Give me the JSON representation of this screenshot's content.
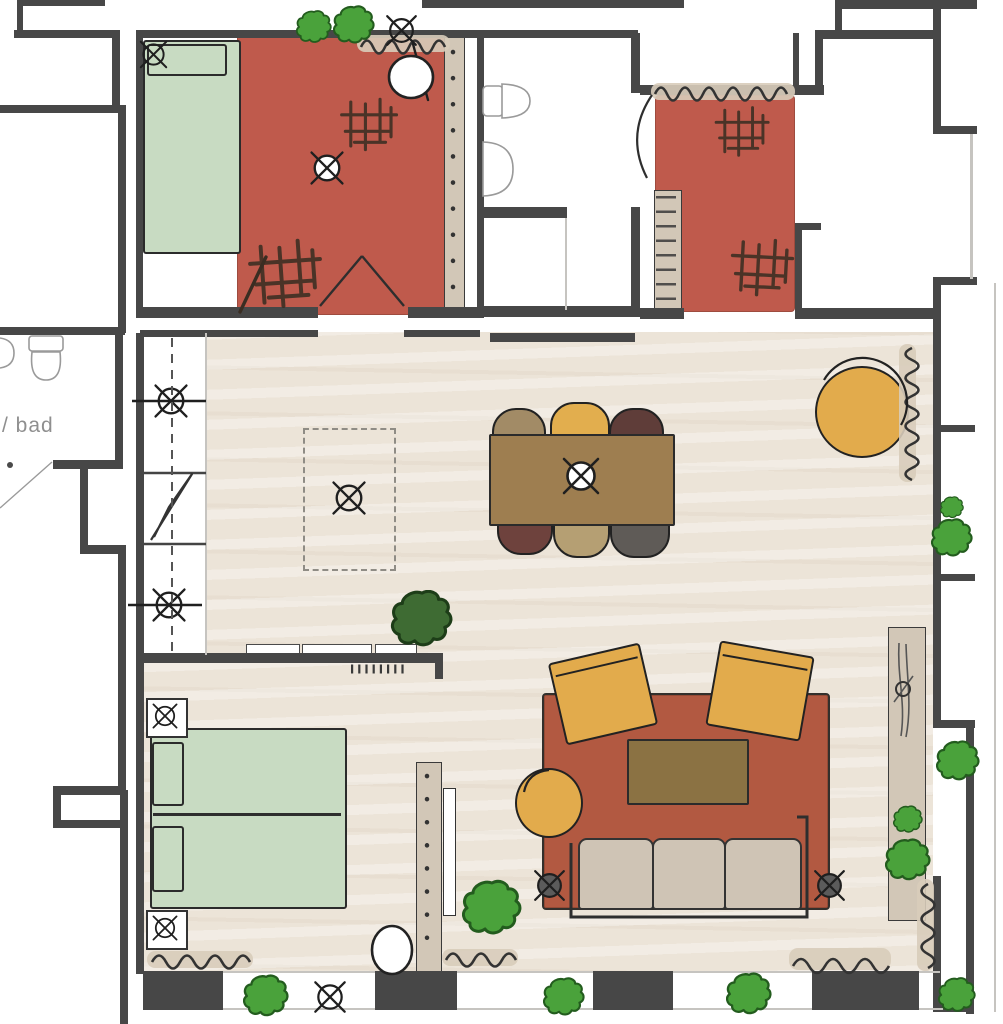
{
  "labels": {
    "left_bathroom": "/ bad"
  },
  "palette": {
    "wall": "#474747",
    "floor": "#ece4d8",
    "rug_red": "#bf5a4c",
    "rug_living": "#b25941",
    "bed_green": "#c8dbc2",
    "accent_yellow": "#e2ab4c",
    "table_brown": "#9e7e50",
    "coffee_brown": "#8b7243",
    "sofa_beige": "#cfc4b5",
    "tan": "#d2c7b7",
    "chair_taupe": "#a28b66",
    "chair_yellow": "#e2ae4e",
    "chair_darkred": "#5f3d39",
    "chair_maroon": "#6e423d",
    "chair_tan": "#b59f73",
    "chair_gray": "#5f5b57",
    "plant_green": "#4aa23b",
    "plant_green_dark": "#3e6b33",
    "speaker_gray": "#5b5b5b",
    "line_dark": "#2e2e2e"
  },
  "symbols_legend": {
    "circle_x_icon": "light fixture",
    "wavy_line_icon": "radiator",
    "cloud_icon": "plant",
    "dashed_rect": "planned furniture",
    "zigzag_icon": "electrical symbol"
  },
  "rooms": {
    "top_left_bedroom": {
      "name": "small bedroom",
      "furniture": [
        "single bed",
        "pillow",
        "red rug",
        "round stool",
        "ceiling light",
        "rug light",
        "radiator",
        "wall shelf with dots"
      ]
    },
    "top_bathroom": {
      "name": "bathroom",
      "furniture": [
        "toilet",
        "washbasin",
        "shower area"
      ]
    },
    "top_right_room": {
      "name": "room with rug",
      "furniture": [
        "red rug",
        "radiator",
        "door leaf",
        "hatched shelf"
      ]
    },
    "left_bathroom": {
      "name": "bathroom",
      "label": "/ bad",
      "furniture": [
        "toilet",
        "corner basin"
      ]
    },
    "corridor": {
      "furniture": [
        "section dashed line",
        "wall light a",
        "wall light b",
        "electrical zigzag symbol"
      ]
    },
    "living_dining": {
      "furniture": [
        "dining table",
        "pendant light",
        "planned cabinet (dashed)",
        "cabinet light",
        "yellow lounge pouf",
        "radiator",
        "window plants"
      ],
      "dining_chairs": [
        {
          "position": "top-left",
          "color": "taupe"
        },
        {
          "position": "top-center",
          "color": "yellow"
        },
        {
          "position": "top-right",
          "color": "dark red"
        },
        {
          "position": "bottom-left",
          "color": "maroon"
        },
        {
          "position": "bottom-center",
          "color": "tan"
        },
        {
          "position": "bottom-right",
          "color": "gray"
        }
      ]
    },
    "sleeping_area": {
      "furniture": [
        "double bed",
        "two pillows",
        "nightstand with lamp x2",
        "room divider with dots",
        "tv panel",
        "round stool",
        "radiator",
        "half wall counter with three trays"
      ]
    },
    "lounge_area": {
      "furniture": [
        "terracotta area rug",
        "three seat sofa",
        "yellow armchair x2",
        "yellow pouf",
        "coffee table",
        "floor lamp x2",
        "tall sideboard",
        "plants",
        "radiators"
      ]
    },
    "outside": {
      "furniture": [
        "balcony plants",
        "outdoor light"
      ]
    }
  }
}
